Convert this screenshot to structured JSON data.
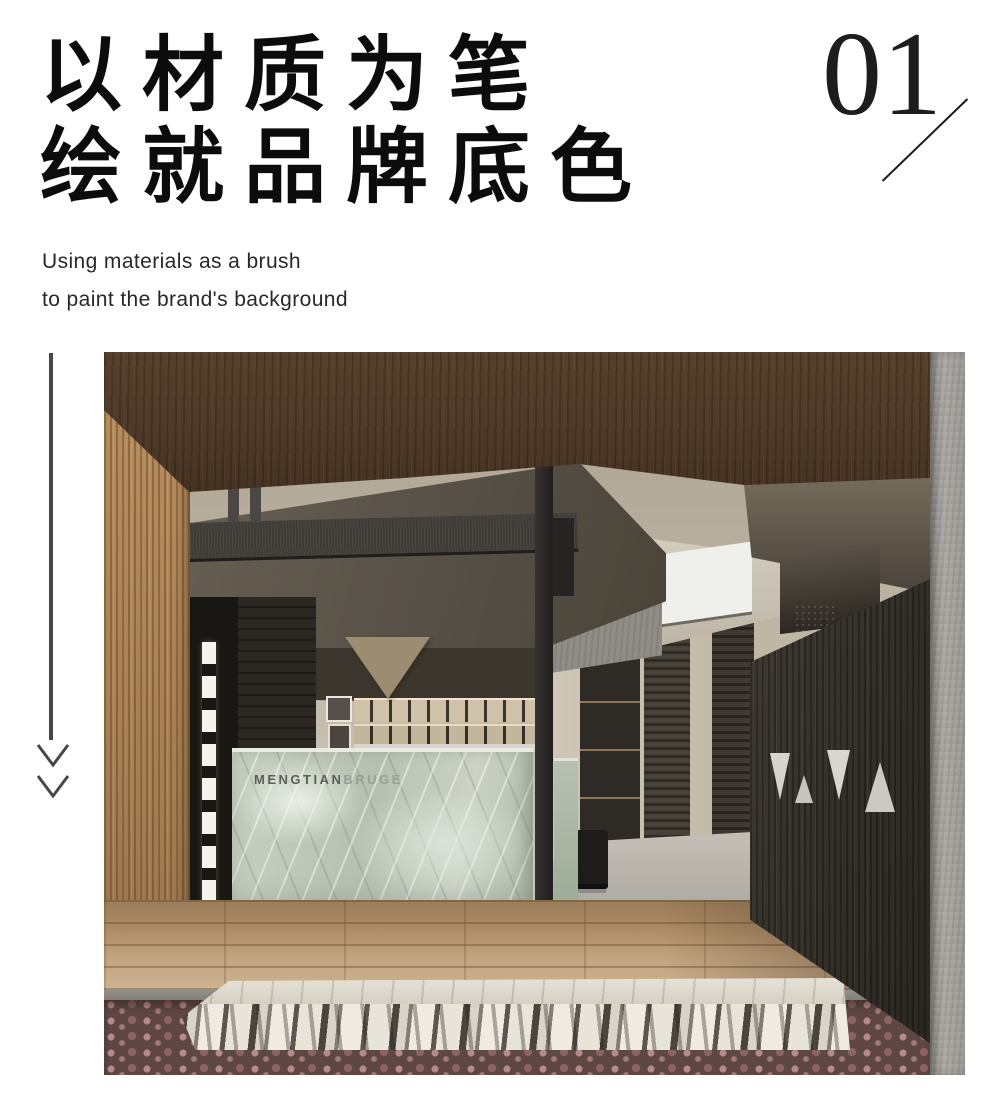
{
  "page": {
    "background": "#ffffff"
  },
  "header": {
    "title_line1": "以材质为笔",
    "title_line2": "绘就品牌底色",
    "subtitle_line1": "Using materials as a brush",
    "subtitle_line2": "to paint the brand's background",
    "section_number": "01"
  },
  "decor": {
    "arrow_icon": "double-chevron-down",
    "rule_color": "#474747",
    "number_slash_color": "#1b1b1b"
  },
  "photo": {
    "description": "Interior rendering of a brand showroom entrance: dark walnut wood ceiling, oak side wall with lit niches, green-grey marble reception desk, backlit display shelving, skylights, dark slatted feature wall with triangular cutouts, concrete column, wood platform floor, veined marble step and red pebble bed",
    "desk_logo": {
      "primary": "MENGTIAN",
      "secondary": "BRUGE"
    },
    "material_colors": {
      "ceiling_wood": "#4a3726",
      "oak_wall": "#b08a5c",
      "desk_marble": "#c3cbbd",
      "dark_feature_wall": "#37332d",
      "concrete_column": "#a5a29d",
      "floor_wood": "#ab8a66",
      "step_marble": "#ece9e2",
      "pebbles": "#9a7472",
      "skylight": "#f2f1ee"
    }
  }
}
